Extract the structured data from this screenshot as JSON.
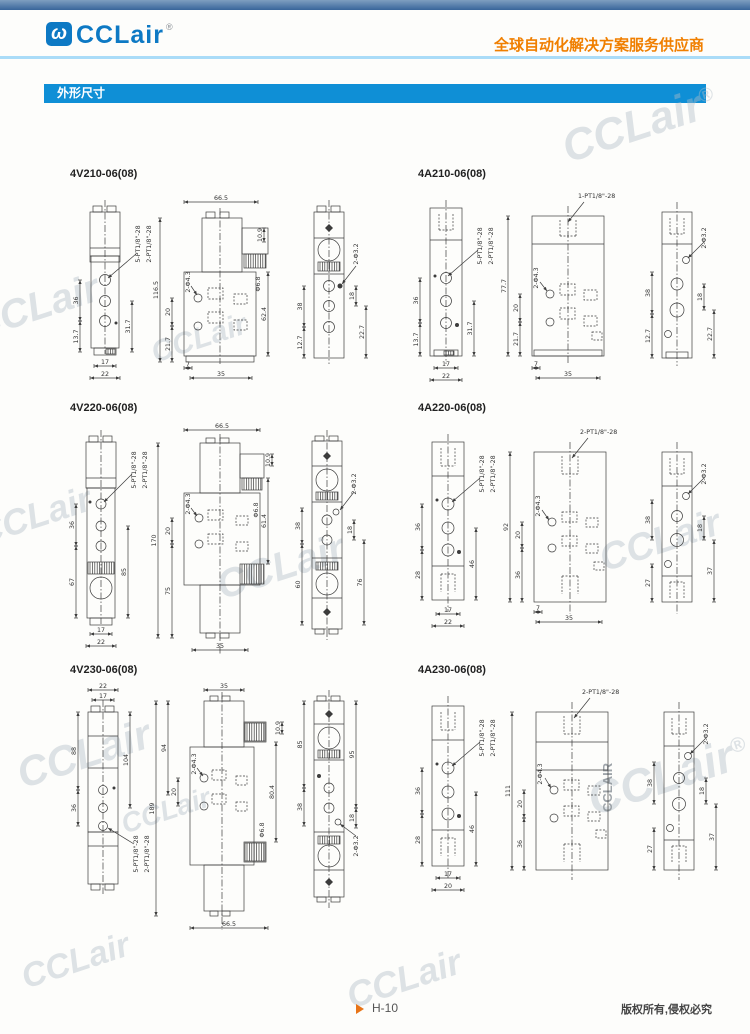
{
  "header": {
    "brand": "CCLair",
    "reg": "®",
    "logo_glyph": "ω",
    "tagline": "全球自动化解决方案服务供应商"
  },
  "section": {
    "title": "外形尺寸"
  },
  "watermark": {
    "text": "CCLair",
    "reg": "®",
    "vertical": "CCLAIR"
  },
  "footer": {
    "page": "H-10",
    "copyright": "版权所有,侵权必究"
  },
  "drawings": {
    "v210": {
      "title": "4V210-06(08)",
      "labels": {
        "p5": "5-PT1/8\"-28",
        "p2": "2-PT1/8\"-28",
        "d36": "36",
        "d137": "13.7",
        "d317": "31.7",
        "d17": "17",
        "d22": "22",
        "d665": "66.5",
        "d1165": "116.5",
        "h43": "2-Φ4.3",
        "d20": "20",
        "d217": "21.7",
        "d7": "7",
        "d35": "35",
        "d624": "62.4",
        "d109": "10.9",
        "h68": "Φ6.8",
        "h32": "2-Φ3.2",
        "d38": "38",
        "d127": "12.7",
        "d18": "18",
        "d227": "22.7"
      }
    },
    "a210": {
      "title": "4A210-06(08)",
      "labels": {
        "p5": "5-PT1/8\"-28",
        "p2": "2-PT1/8\"-28",
        "p1": "1-PT1/8\"-28",
        "d36": "36",
        "d137": "13.7",
        "d317": "31.7",
        "d17": "17",
        "d22": "22",
        "d777": "77.7",
        "h43": "2-Φ4.3",
        "d20": "20",
        "d217": "21.7",
        "d7": "7",
        "d35": "35",
        "h32": "2-Φ3.2",
        "d38": "38",
        "d127": "12.7",
        "d18": "18",
        "d227": "22.7"
      }
    },
    "v220": {
      "title": "4V220-06(08)",
      "labels": {
        "p5": "5-PT1/8\"-28",
        "p2": "2-PT1/8\"-28",
        "d36": "36",
        "d67": "67",
        "d85": "85",
        "d17": "17",
        "d22": "22",
        "d665": "66.5",
        "d170": "170",
        "h43": "2-Φ4.3",
        "d20": "20",
        "d75": "75",
        "d614": "61.4",
        "d35": "35",
        "d109": "10.9",
        "h68": "Φ6.8",
        "h32": "2-Φ3.2",
        "d38": "38",
        "d18": "18",
        "d60": "60",
        "d76": "76"
      }
    },
    "a220": {
      "title": "4A220-06(08)",
      "labels": {
        "p5": "5-PT1/8\"-28",
        "p2": "2-PT1/8\"-28",
        "d36": "36",
        "d28": "28",
        "d46": "46",
        "d17": "17",
        "d22": "22",
        "d92": "92",
        "h43": "2-Φ4.3",
        "d20": "20",
        "d7": "7",
        "d35": "35",
        "h32": "2-Φ3.2",
        "d38": "38",
        "d18": "18",
        "d27": "27",
        "d37": "37"
      }
    },
    "v230": {
      "title": "4V230-06(08)",
      "labels": {
        "d22": "22",
        "d17": "17",
        "d88": "88",
        "d104": "104",
        "d36": "36",
        "p5": "5-PT1/8\"-28",
        "p2": "2-PT1/8\"-28",
        "d35": "35",
        "d94": "94",
        "d189": "189",
        "d20": "20",
        "d804": "80.4",
        "d665": "66.5",
        "h43": "2-Φ4.3",
        "h68": "Φ6.8",
        "d109": "10.9",
        "d85": "85",
        "d95": "95",
        "d38": "38",
        "d18": "18",
        "h32": "2-Φ3.2"
      }
    },
    "a230": {
      "title": "4A230-06(08)",
      "labels": {
        "p5": "5-PT1/8\"-28",
        "p2": "2-PT1/8\"-28",
        "d36": "36",
        "d28": "28",
        "d46": "46",
        "d17": "17",
        "d20": "20",
        "d111": "111",
        "h43": "2-Φ4.3",
        "h32": "2-Φ3.2",
        "d38": "38",
        "d27": "27",
        "d18": "18",
        "d37": "37"
      }
    }
  }
}
